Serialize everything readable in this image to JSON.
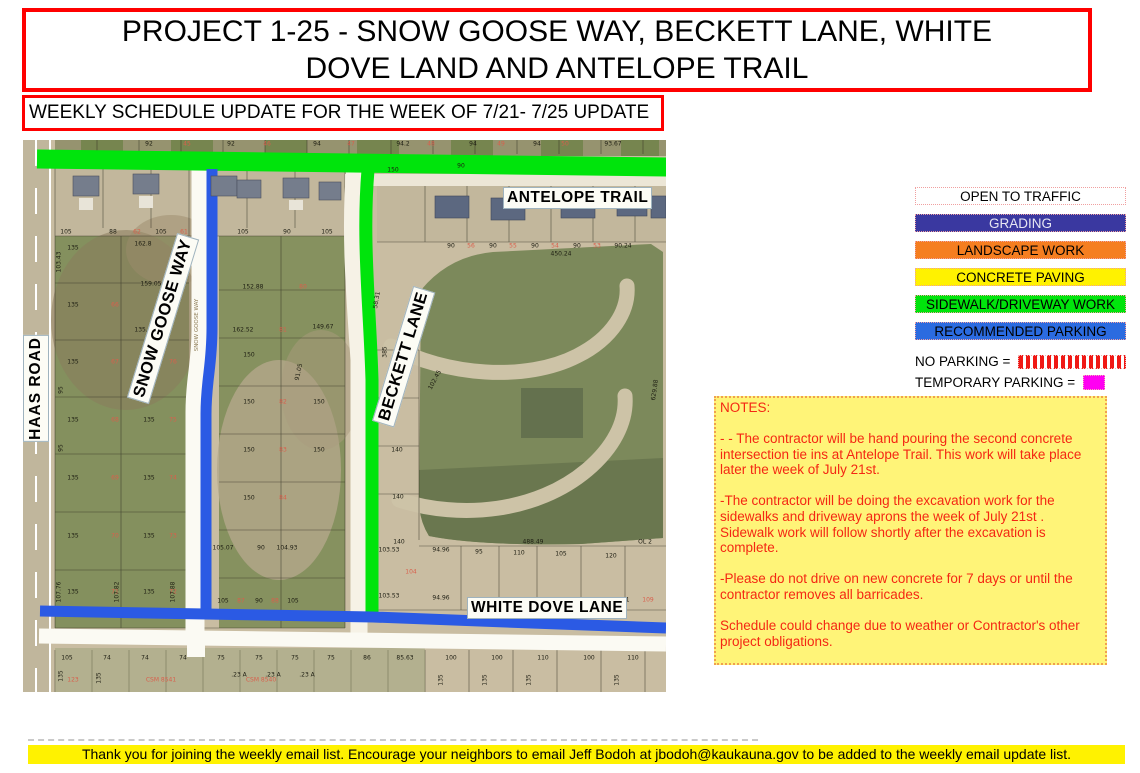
{
  "title": "PROJECT 1-25 - SNOW GOOSE WAY, BECKETT LANE, WHITE DOVE LAND AND ANTELOPE TRAIL",
  "subtitle": "WEEKLY SCHEDULE UPDATE FOR THE WEEK OF 7/21- 7/25 UPDATE",
  "legend": {
    "items": [
      {
        "label": "OPEN TO TRAFFIC",
        "bg": "#ffffff",
        "fg": "#000000"
      },
      {
        "label": "GRADING",
        "bg": "#3a38a0",
        "fg": "#e6e6f2"
      },
      {
        "label": "LANDSCAPE WORK",
        "bg": "#f57e20",
        "fg": "#000000"
      },
      {
        "label": "CONCRETE PAVING",
        "bg": "#fff200",
        "fg": "#000000"
      },
      {
        "label": "SIDEWALK/DRIVEWAY WORK",
        "bg": "#00e40c",
        "fg": "#000000"
      },
      {
        "label": "RECOMMENDED PARKING",
        "bg": "#2b6be0",
        "fg": "#000000"
      }
    ],
    "no_parking_label": "NO PARKING =",
    "temporary_parking_label": "TEMPORARY PARKING =",
    "no_parking_color": "#f01814",
    "temporary_parking_color": "#ff00f2"
  },
  "notes": {
    "heading": "NOTES:",
    "paragraphs": [
      "- - The contractor will be hand pouring the second concrete intersection tie ins at Antelope Trail.  This work will take place later the week of July 21st.",
      "-The contractor will be doing the excavation work for the sidewalks and driveway aprons the week of July 21st . Sidewalk work will follow shortly after the excavation is complete.",
      "-Please do not drive on new concrete for 7 days or until the contractor removes all barricades.",
      "Schedule could change due to weather or Contractor's other project obligations."
    ]
  },
  "map": {
    "road_labels": {
      "haas": "HAAS ROAD",
      "snow_goose": "SNOW GOOSE WAY",
      "beckett": "BECKETT LANE",
      "antelope": "ANTELOPE TRAIL",
      "white_dove": "WHITE DOVE LANE"
    },
    "parcel_labels": [
      {
        "t": "92",
        "x": 128,
        "y": 4
      },
      {
        "t": "92",
        "x": 210,
        "y": 4
      },
      {
        "t": "94",
        "x": 296,
        "y": 4
      },
      {
        "t": "94.2",
        "x": 382,
        "y": 4
      },
      {
        "t": "94",
        "x": 452,
        "y": 4
      },
      {
        "t": "94",
        "x": 516,
        "y": 4
      },
      {
        "t": "93.67",
        "x": 592,
        "y": 4
      },
      {
        "t": "45",
        "x": 166,
        "y": 4,
        "c": "#d95f4c"
      },
      {
        "t": "46",
        "x": 246,
        "y": 4,
        "c": "#d95f4c"
      },
      {
        "t": "47",
        "x": 330,
        "y": 4,
        "c": "#d95f4c"
      },
      {
        "t": "48",
        "x": 410,
        "y": 4,
        "c": "#d95f4c"
      },
      {
        "t": "49",
        "x": 480,
        "y": 4,
        "c": "#d95f4c"
      },
      {
        "t": "50",
        "x": 544,
        "y": 4,
        "c": "#d95f4c"
      },
      {
        "t": "105",
        "x": 45,
        "y": 92
      },
      {
        "t": "88",
        "x": 92,
        "y": 92
      },
      {
        "t": "105",
        "x": 140,
        "y": 92
      },
      {
        "t": "105",
        "x": 222,
        "y": 92
      },
      {
        "t": "90",
        "x": 266,
        "y": 92
      },
      {
        "t": "105",
        "x": 306,
        "y": 92
      },
      {
        "t": "62",
        "x": 116,
        "y": 92,
        "c": "#d95f4c"
      },
      {
        "t": "61",
        "x": 163,
        "y": 92,
        "c": "#d95f4c"
      },
      {
        "t": "150",
        "x": 372,
        "y": 30
      },
      {
        "t": "90",
        "x": 440,
        "y": 26
      },
      {
        "t": "89.92",
        "x": 612,
        "y": 56
      },
      {
        "t": "90",
        "x": 430,
        "y": 106
      },
      {
        "t": "90",
        "x": 472,
        "y": 106
      },
      {
        "t": "90",
        "x": 514,
        "y": 106
      },
      {
        "t": "90",
        "x": 556,
        "y": 106
      },
      {
        "t": "90.24",
        "x": 602,
        "y": 106
      },
      {
        "t": "56",
        "x": 450,
        "y": 106,
        "c": "#d95f4c"
      },
      {
        "t": "55",
        "x": 492,
        "y": 106,
        "c": "#d95f4c"
      },
      {
        "t": "54",
        "x": 534,
        "y": 106,
        "c": "#d95f4c"
      },
      {
        "t": "53",
        "x": 576,
        "y": 106,
        "c": "#d95f4c"
      },
      {
        "t": "450.24",
        "x": 540,
        "y": 114
      },
      {
        "t": "135",
        "x": 52,
        "y": 108
      },
      {
        "t": "162.8",
        "x": 122,
        "y": 104
      },
      {
        "t": "159.05",
        "x": 130,
        "y": 144
      },
      {
        "t": "135",
        "x": 52,
        "y": 165
      },
      {
        "t": "66",
        "x": 94,
        "y": 165,
        "c": "#d95f4c"
      },
      {
        "t": "135.8",
        "x": 122,
        "y": 190
      },
      {
        "t": "135",
        "x": 52,
        "y": 222
      },
      {
        "t": "67",
        "x": 94,
        "y": 222,
        "c": "#d95f4c"
      },
      {
        "t": "135",
        "x": 128,
        "y": 222
      },
      {
        "t": "76",
        "x": 152,
        "y": 222,
        "c": "#d95f4c"
      },
      {
        "t": "135",
        "x": 52,
        "y": 280
      },
      {
        "t": "68",
        "x": 94,
        "y": 280,
        "c": "#d95f4c"
      },
      {
        "t": "135",
        "x": 128,
        "y": 280
      },
      {
        "t": "75",
        "x": 152,
        "y": 280,
        "c": "#d95f4c"
      },
      {
        "t": "135",
        "x": 52,
        "y": 338
      },
      {
        "t": "69",
        "x": 94,
        "y": 338,
        "c": "#d95f4c"
      },
      {
        "t": "135",
        "x": 128,
        "y": 338
      },
      {
        "t": "74",
        "x": 152,
        "y": 338,
        "c": "#d95f4c"
      },
      {
        "t": "135",
        "x": 52,
        "y": 396
      },
      {
        "t": "70",
        "x": 94,
        "y": 396,
        "c": "#d95f4c"
      },
      {
        "t": "135",
        "x": 128,
        "y": 396
      },
      {
        "t": "73",
        "x": 152,
        "y": 396,
        "c": "#d95f4c"
      },
      {
        "t": "135",
        "x": 52,
        "y": 452
      },
      {
        "t": "71",
        "x": 94,
        "y": 452,
        "c": "#d95f4c"
      },
      {
        "t": "135",
        "x": 128,
        "y": 452
      },
      {
        "t": "72",
        "x": 152,
        "y": 452,
        "c": "#d95f4c"
      },
      {
        "t": "103.43",
        "x": 38,
        "y": 122,
        "r": -90
      },
      {
        "t": "95",
        "x": 40,
        "y": 250,
        "r": -90
      },
      {
        "t": "95",
        "x": 40,
        "y": 308,
        "r": -90
      },
      {
        "t": "107.76",
        "x": 38,
        "y": 452,
        "r": -90
      },
      {
        "t": "107.82",
        "x": 96,
        "y": 452,
        "r": -90
      },
      {
        "t": "107.88",
        "x": 152,
        "y": 452,
        "r": -90
      },
      {
        "t": "152.88",
        "x": 232,
        "y": 147
      },
      {
        "t": "80",
        "x": 282,
        "y": 147,
        "c": "#d95f4c"
      },
      {
        "t": "162.52",
        "x": 222,
        "y": 190
      },
      {
        "t": "81",
        "x": 262,
        "y": 190,
        "c": "#d95f4c"
      },
      {
        "t": "149.67",
        "x": 302,
        "y": 187
      },
      {
        "t": "150",
        "x": 228,
        "y": 215
      },
      {
        "t": "91.05",
        "x": 278,
        "y": 232,
        "r": -78
      },
      {
        "t": "150",
        "x": 228,
        "y": 262
      },
      {
        "t": "82",
        "x": 262,
        "y": 262,
        "c": "#d95f4c"
      },
      {
        "t": "150",
        "x": 298,
        "y": 262
      },
      {
        "t": "150",
        "x": 228,
        "y": 310
      },
      {
        "t": "83",
        "x": 262,
        "y": 310,
        "c": "#d95f4c"
      },
      {
        "t": "150",
        "x": 298,
        "y": 310
      },
      {
        "t": "150",
        "x": 228,
        "y": 358
      },
      {
        "t": "84",
        "x": 262,
        "y": 358,
        "c": "#d95f4c"
      },
      {
        "t": "105.07",
        "x": 202,
        "y": 408
      },
      {
        "t": "90",
        "x": 240,
        "y": 408
      },
      {
        "t": "104.93",
        "x": 266,
        "y": 408
      },
      {
        "t": "105",
        "x": 202,
        "y": 461
      },
      {
        "t": "87",
        "x": 220,
        "y": 461,
        "c": "#d95f4c"
      },
      {
        "t": "90",
        "x": 238,
        "y": 461
      },
      {
        "t": "88",
        "x": 254,
        "y": 461,
        "c": "#d95f4c"
      },
      {
        "t": "105",
        "x": 272,
        "y": 461
      },
      {
        "t": "SNOW GOOSE WAY",
        "x": 176,
        "y": 185,
        "r": -90,
        "c": "#8d7c55",
        "s": 5.5
      },
      {
        "t": "58.31",
        "x": 356,
        "y": 160,
        "r": -80
      },
      {
        "t": "53.92",
        "x": 394,
        "y": 178
      },
      {
        "t": "102.45",
        "x": 414,
        "y": 240,
        "r": -62
      },
      {
        "t": "140",
        "x": 374,
        "y": 262
      },
      {
        "t": "140",
        "x": 376,
        "y": 310
      },
      {
        "t": "140",
        "x": 377,
        "y": 357
      },
      {
        "t": "140",
        "x": 378,
        "y": 402
      },
      {
        "t": "385",
        "x": 364,
        "y": 212,
        "r": -90
      },
      {
        "t": "629.88",
        "x": 634,
        "y": 250,
        "r": -82
      },
      {
        "t": "488.49",
        "x": 512,
        "y": 402
      },
      {
        "t": "OL 2",
        "x": 624,
        "y": 402
      },
      {
        "t": "103.53",
        "x": 368,
        "y": 410
      },
      {
        "t": "94.96",
        "x": 420,
        "y": 410
      },
      {
        "t": "95",
        "x": 458,
        "y": 412
      },
      {
        "t": "110",
        "x": 498,
        "y": 413
      },
      {
        "t": "105",
        "x": 540,
        "y": 414
      },
      {
        "t": "120",
        "x": 590,
        "y": 416
      },
      {
        "t": "104",
        "x": 390,
        "y": 432,
        "c": "#d95f4c"
      },
      {
        "t": "103.53",
        "x": 368,
        "y": 456
      },
      {
        "t": "94.96",
        "x": 420,
        "y": 458
      },
      {
        "t": "120.1",
        "x": 600,
        "y": 460
      },
      {
        "t": "109",
        "x": 627,
        "y": 460,
        "c": "#d95f4c"
      },
      {
        "t": "105",
        "x": 46,
        "y": 518
      },
      {
        "t": "74",
        "x": 86,
        "y": 518
      },
      {
        "t": "74",
        "x": 124,
        "y": 518
      },
      {
        "t": "74",
        "x": 162,
        "y": 518
      },
      {
        "t": "75",
        "x": 200,
        "y": 518
      },
      {
        "t": "75",
        "x": 238,
        "y": 518
      },
      {
        "t": "75",
        "x": 274,
        "y": 518
      },
      {
        "t": "75",
        "x": 310,
        "y": 518
      },
      {
        "t": "86",
        "x": 346,
        "y": 518
      },
      {
        "t": "85.63",
        "x": 384,
        "y": 518
      },
      {
        "t": "100",
        "x": 430,
        "y": 518
      },
      {
        "t": "100",
        "x": 476,
        "y": 518
      },
      {
        "t": "110",
        "x": 522,
        "y": 518
      },
      {
        "t": "100",
        "x": 568,
        "y": 518
      },
      {
        "t": "110",
        "x": 612,
        "y": 518
      },
      {
        "t": ".23 A",
        "x": 218,
        "y": 535
      },
      {
        "t": ".23 A",
        "x": 252,
        "y": 535
      },
      {
        "t": ".23 A",
        "x": 286,
        "y": 535
      },
      {
        "t": "123",
        "x": 52,
        "y": 540,
        "c": "#d95f4c"
      },
      {
        "t": "CSM 8541",
        "x": 140,
        "y": 540,
        "c": "#d95f4c"
      },
      {
        "t": "CSM 8540",
        "x": 240,
        "y": 540,
        "c": "#d95f4c"
      },
      {
        "t": "135",
        "x": 40,
        "y": 536,
        "r": -90
      },
      {
        "t": "135",
        "x": 78,
        "y": 538,
        "r": -90
      },
      {
        "t": "135",
        "x": 420,
        "y": 540,
        "r": -90
      },
      {
        "t": "135",
        "x": 464,
        "y": 540,
        "r": -90
      },
      {
        "t": "135",
        "x": 508,
        "y": 540,
        "r": -90
      },
      {
        "t": "135",
        "x": 596,
        "y": 540,
        "r": -90
      }
    ]
  },
  "footer": "Thank you for joining the weekly email list. Encourage your neighbors to email Jeff Bodoh at jbodoh@kaukauna.gov to be added to the weekly email update list.",
  "colors": {
    "banner_border_red": "#ff0000",
    "open_road_white": "#ffffff",
    "grading_blue": "#3a38a0",
    "landscape_orange": "#f57e20",
    "concrete_yellow": "#fff200",
    "sidewalk_green": "#00e40c",
    "parking_blue": "#2b5ae4",
    "no_parking_red": "#f01814",
    "temporary_magenta": "#ff00f2",
    "notes_bg": "#fff478",
    "notes_text": "#f42713",
    "footer_bg": "#fff200"
  }
}
